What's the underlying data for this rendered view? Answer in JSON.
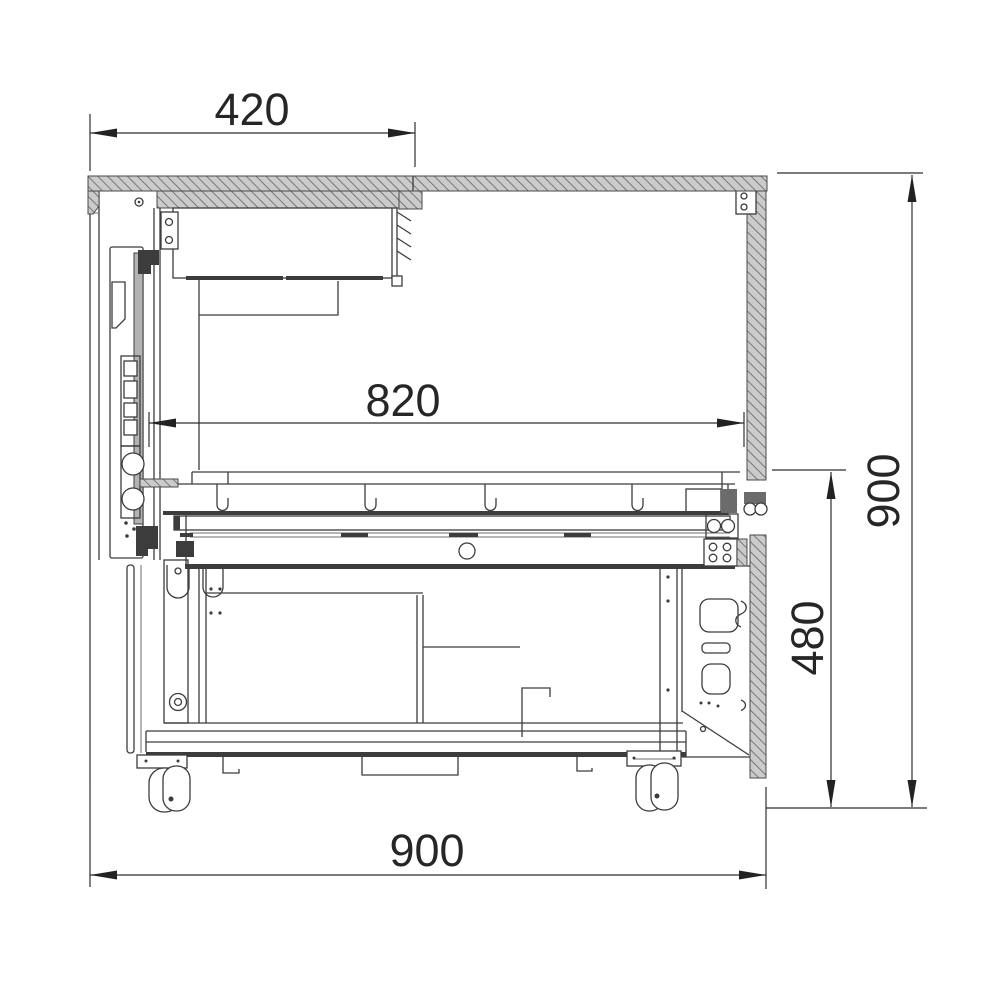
{
  "drawing": {
    "dimensions": {
      "top_depth": {
        "label": "420",
        "orientation": "horizontal"
      },
      "inner_width": {
        "label": "820",
        "orientation": "horizontal"
      },
      "overall_width": {
        "label": "900",
        "orientation": "horizontal"
      },
      "overall_height": {
        "label": "900",
        "orientation": "vertical"
      },
      "base_height": {
        "label": "480",
        "orientation": "vertical"
      }
    },
    "colors": {
      "line": "#3c3c3c",
      "dimension_text": "#262626",
      "hatch_fill": "#cbcbcb",
      "hatch_stroke": "#777777",
      "background": "#ffffff"
    }
  }
}
